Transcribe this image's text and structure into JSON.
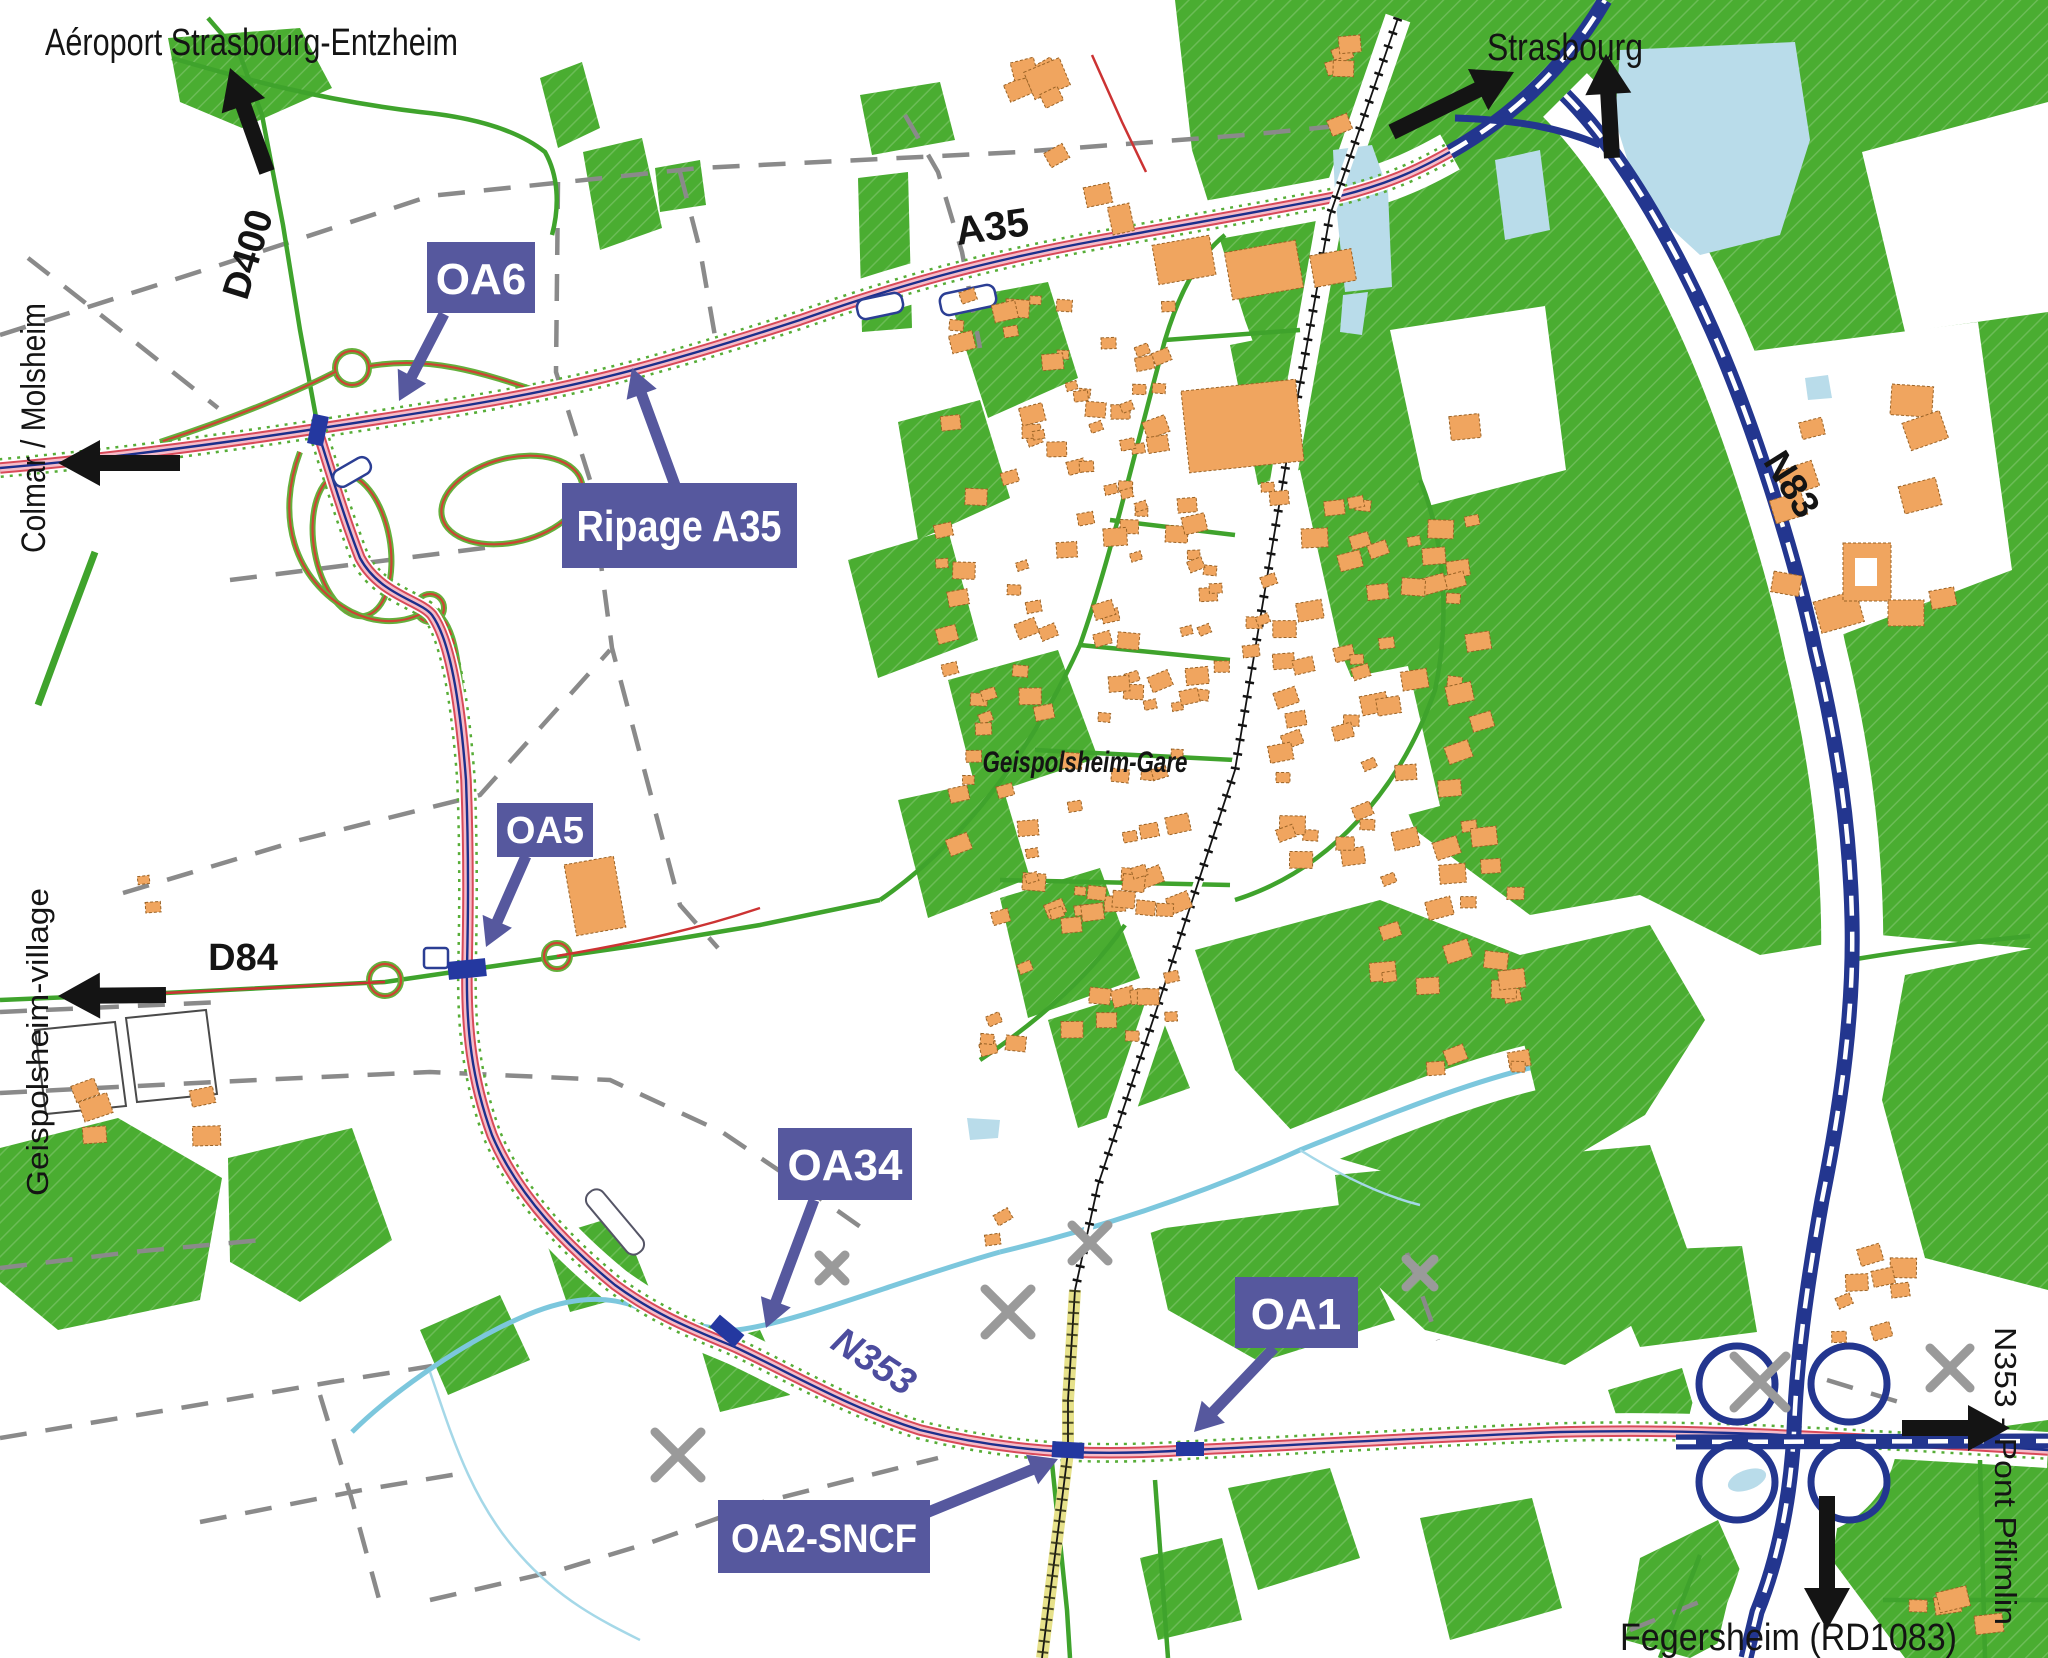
{
  "map": {
    "colors": {
      "background": "#ffffff",
      "vegetation": "#4aad31",
      "building": "#f0a55f",
      "water": "#b9dcea",
      "boundary_gray": "#8a8a8a",
      "label_box": "#56589e",
      "callout_arrow": "#56589e",
      "black_arrow": "#141414",
      "motorway_blue": "#23368f",
      "project_road_red": "#d84a5a",
      "project_road_pink": "#f5bcc9",
      "railway_yellow": "#e6e18a",
      "stream_blue": "#7cc7dd",
      "local_road_green": "#3fa32c"
    },
    "direction_labels": [
      {
        "id": "airport",
        "text": "Aéroport Strasbourg-Entzheim"
      },
      {
        "id": "strasbourg",
        "text": "Strasbourg"
      },
      {
        "id": "colmar-molsheim",
        "text": "Colmar / Molsheim"
      },
      {
        "id": "geispolsheim-village",
        "text": "Geispolsheim-village"
      },
      {
        "id": "pont-pflimlin",
        "text": "N353 - Pont Pflimlin"
      },
      {
        "id": "fegersheim",
        "text": "Fegersheim (RD1083)"
      }
    ],
    "road_labels": [
      {
        "id": "d400",
        "text": "D400"
      },
      {
        "id": "a35",
        "text": "A35"
      },
      {
        "id": "d84",
        "text": "D84"
      },
      {
        "id": "n83",
        "text": "N83"
      },
      {
        "id": "n353",
        "text": "N353"
      }
    ],
    "place_labels": [
      {
        "id": "geispolsheim-gare",
        "text": "Geispolsheim-Gare"
      }
    ],
    "structure_callouts": [
      {
        "id": "oa6",
        "text": "OA6"
      },
      {
        "id": "ripage-a35",
        "text": "Ripage A35"
      },
      {
        "id": "oa5",
        "text": "OA5"
      },
      {
        "id": "oa34",
        "text": "OA34"
      },
      {
        "id": "oa1",
        "text": "OA1"
      },
      {
        "id": "oa2-sncf",
        "text": "OA2-SNCF"
      }
    ]
  }
}
